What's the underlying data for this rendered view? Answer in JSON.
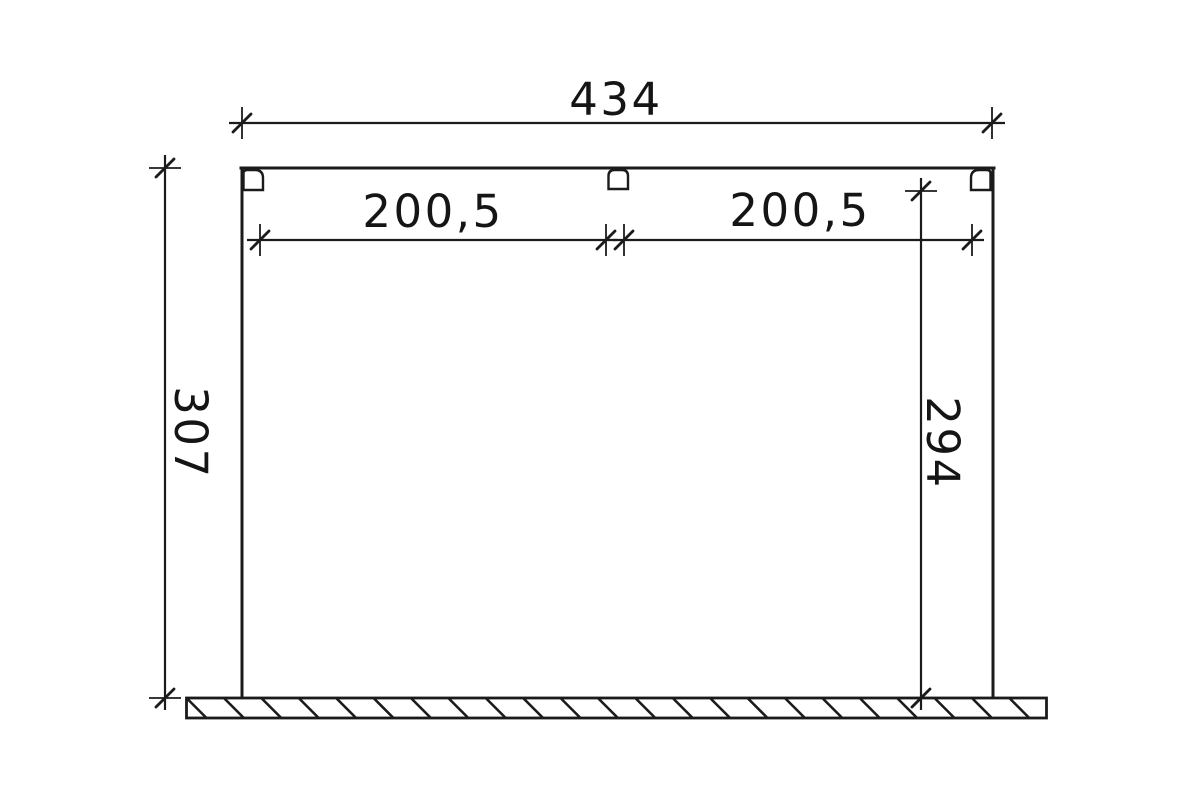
{
  "drawing": {
    "background_color": "#ffffff",
    "line_color": "#1b1b1b",
    "dimensions": {
      "overall_width": {
        "label": "434",
        "value": 434
      },
      "span_left": {
        "label": "200,5",
        "value": 200.5
      },
      "span_right": {
        "label": "200,5",
        "value": 200.5
      },
      "height_left": {
        "label": "307",
        "value": 307
      },
      "height_right": {
        "label": "294",
        "value": 294
      }
    }
  }
}
